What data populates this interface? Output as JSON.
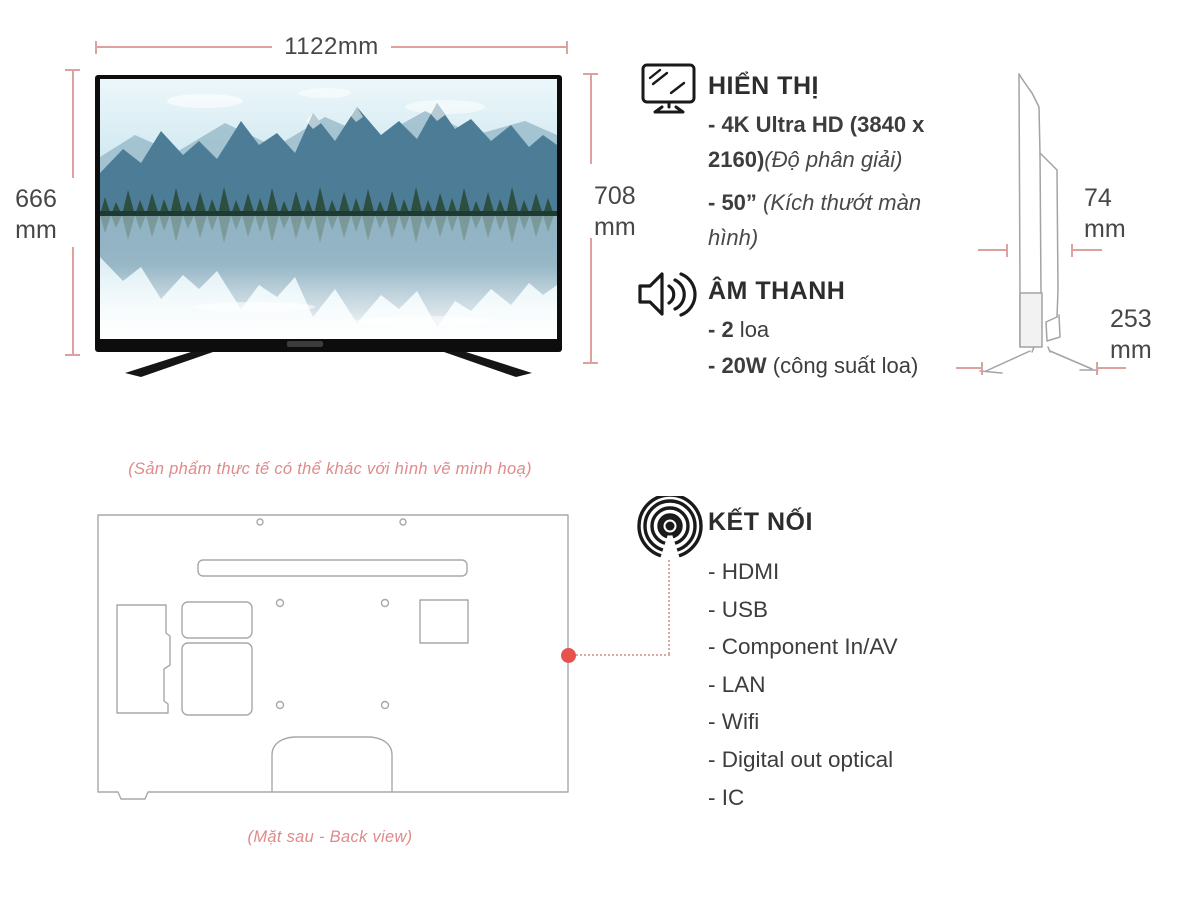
{
  "front_view": {
    "width_dim": {
      "value": "1122",
      "unit": "mm"
    },
    "height_dim_left": {
      "value": "666",
      "unit": "mm"
    },
    "height_dim_right": {
      "value": "708",
      "unit": "mm"
    }
  },
  "side_view": {
    "depth_dim": {
      "value": "74",
      "unit": "mm"
    },
    "stand_depth_dim": {
      "value": "253",
      "unit": "mm"
    }
  },
  "specs": {
    "display": {
      "title": "HIỂN THỊ",
      "items": [
        {
          "bold": "- 4K Ultra HD (3840 x 2160)",
          "italic": "(Độ phân giải)"
        },
        {
          "bold": "- 50”",
          "italic": " (Kích thướt màn hình)"
        }
      ]
    },
    "audio": {
      "title": "ÂM THANH",
      "items": [
        {
          "bold": "- 2",
          "normal": " loa"
        },
        {
          "bold": "- 20W",
          "normal": " (công suất loa)"
        }
      ]
    },
    "connectivity": {
      "title": "KẾT NỐI",
      "items": [
        "- HDMI",
        "- USB",
        "- Component In/AV",
        "- LAN",
        "- Wifi",
        "- Digital out optical",
        "- IC"
      ]
    }
  },
  "notes": {
    "disclaimer": "(Sản phẩm thực tế có thể khác với hình vẽ minh hoạ)",
    "back_view_caption": "(Mặt sau - Back view)"
  },
  "icons": {
    "display": "monitor-icon",
    "audio": "speaker-icon",
    "connectivity": "signal-icon"
  },
  "colors": {
    "dimension_line": "#dfa0a0",
    "note_text": "#e08a8a",
    "accent_dot": "#e8524d",
    "text_primary": "#3a3a3a",
    "drawing_stroke": "#a8a8a8"
  }
}
